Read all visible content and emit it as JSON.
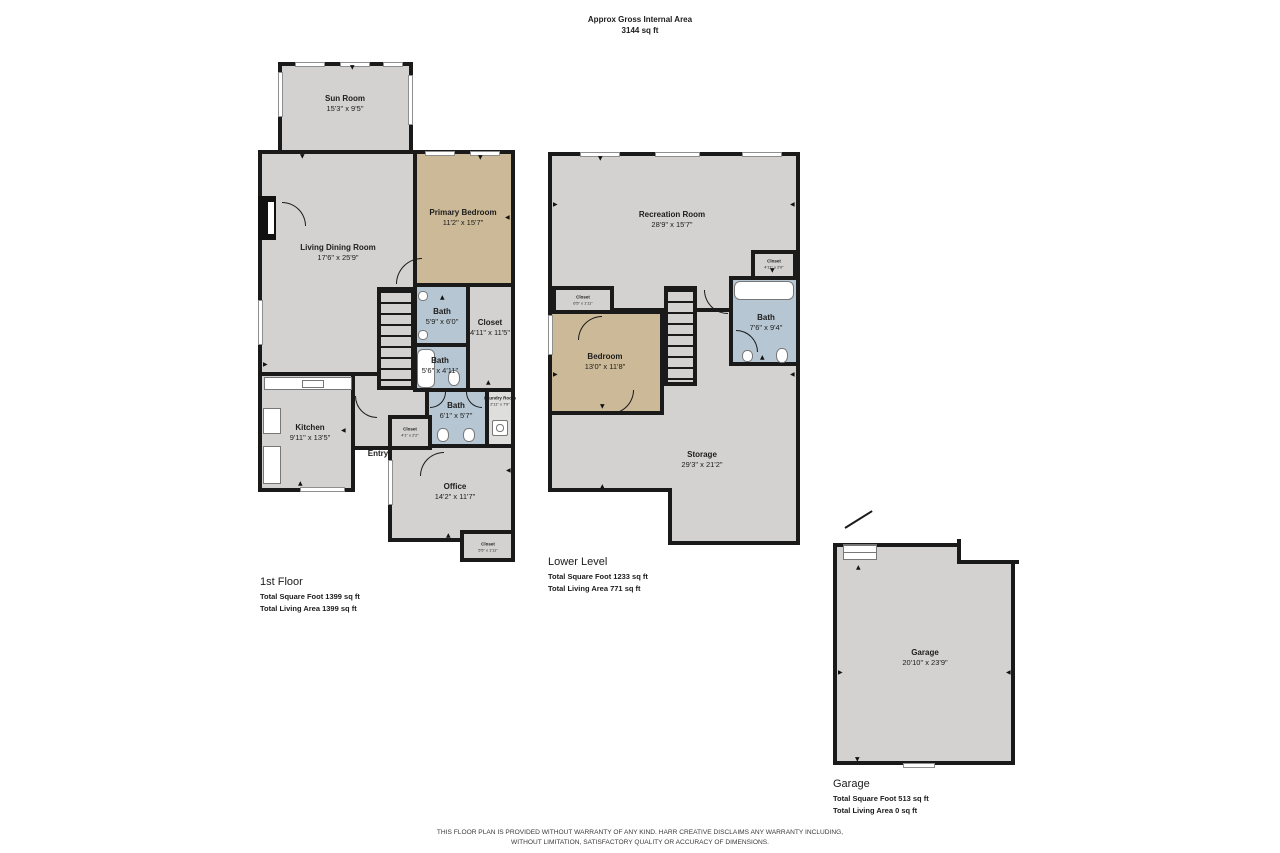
{
  "header": {
    "title": "Approx Gross Internal Area",
    "subtitle": "3144 sq ft"
  },
  "colors": {
    "wall": "#1a1a1a",
    "room_gray": "#d3d2d0",
    "bedroom_tan": "#cbb997",
    "bath_blue": "#b6c7d3",
    "laundry_gray": "#dededc",
    "background": "#ffffff"
  },
  "floors": {
    "first": {
      "title": "1st Floor",
      "stat1": "Total Square Foot 1399 sq ft",
      "stat2": "Total Living Area 1399 sq ft",
      "rooms": {
        "sun_room": {
          "name": "Sun Room",
          "dims": "15'3\" x 9'5\""
        },
        "living_dining": {
          "name": "Living Dining Room",
          "dims": "17'6\" x 25'9\""
        },
        "primary_bedroom": {
          "name": "Primary Bedroom",
          "dims": "11'2\" x 15'7\""
        },
        "bath_upper": {
          "name": "Bath",
          "dims": "5'9\" x 6'0\""
        },
        "closet_hall": {
          "name": "Closet",
          "dims": "4'11\" x 11'5\""
        },
        "bath_middle": {
          "name": "Bath",
          "dims": "5'6\" x 4'11\""
        },
        "bath_lower": {
          "name": "Bath",
          "dims": "6'1\" x 5'7\""
        },
        "laundry": {
          "name": "Laundry Room",
          "dims": "2'11\" x 7'9\""
        },
        "kitchen": {
          "name": "Kitchen",
          "dims": "9'11\" x 13'5\""
        },
        "entry": {
          "name": "Entry",
          "dims": ""
        },
        "closet_entry": {
          "name": "Closet",
          "dims": "4'1\" x 2'2\""
        },
        "office": {
          "name": "Office",
          "dims": "14'2\" x 11'7\""
        },
        "closet_office": {
          "name": "Closet",
          "dims": "5'5\" x 1'11\""
        }
      }
    },
    "lower": {
      "title": "Lower Level",
      "stat1": "Total Square Foot 1233 sq ft",
      "stat2": "Total Living Area 771 sq ft",
      "rooms": {
        "recreation": {
          "name": "Recreation Room",
          "dims": "28'9\" x 15'7\""
        },
        "closet_left": {
          "name": "Closet",
          "dims": "6'5\" x 1'11\""
        },
        "closet_top": {
          "name": "Closet",
          "dims": "4'11\" x 2'0\""
        },
        "bedroom": {
          "name": "Bedroom",
          "dims": "13'0\" x 11'8\""
        },
        "bath": {
          "name": "Bath",
          "dims": "7'6\" x 9'4\""
        },
        "storage": {
          "name": "Storage",
          "dims": "29'3\" x 21'2\""
        }
      }
    },
    "garage": {
      "title": "Garage",
      "stat1": "Total Square Foot 513 sq ft",
      "stat2": "Total Living Area 0 sq ft",
      "rooms": {
        "garage": {
          "name": "Garage",
          "dims": "20'10\" x 23'9\""
        }
      }
    }
  },
  "disclaimer": {
    "line1": "THIS FLOOR PLAN IS PROVIDED WITHOUT WARRANTY OF ANY KIND. HARR CREATIVE DISCLAIMS ANY WARRANTY INCLUDING,",
    "line2": "WITHOUT LIMITATION, SATISFACTORY QUALITY OR ACCURACY OF DIMENSIONS."
  }
}
